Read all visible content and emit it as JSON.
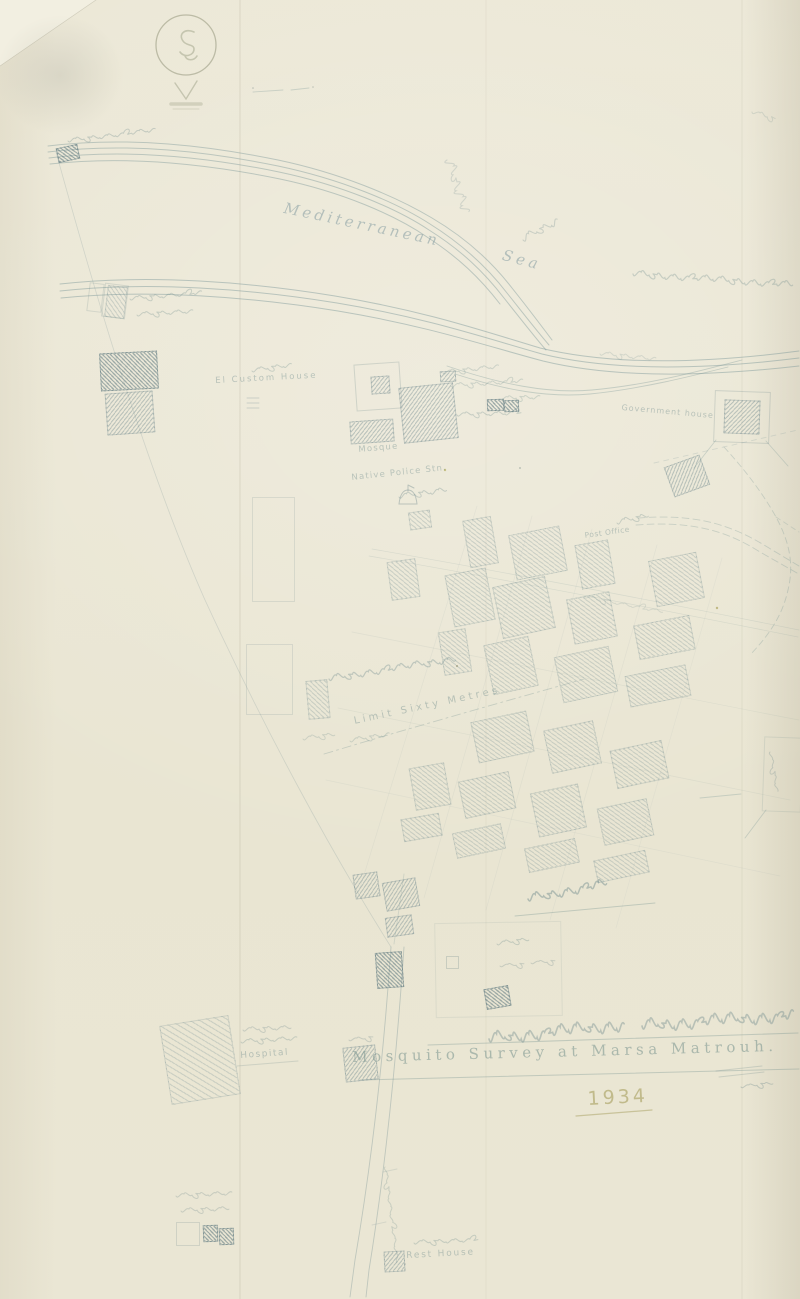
{
  "page": {
    "width": 800,
    "height": 1299,
    "background": "#ebe7d5"
  },
  "colors": {
    "ink": "#7a9496",
    "ink_faint": "#9db0ae",
    "olive": "#a89f60",
    "paper": "#ebe7d5",
    "paper_light": "#f2efe1"
  },
  "map": {
    "labels": [
      {
        "id": "sea-word-1",
        "text": "Mediterranean",
        "x": 286,
        "y": 199,
        "rot": 12,
        "size": 15,
        "ls": 3.5,
        "cls": "lbl-sea"
      },
      {
        "id": "sea-word-2",
        "text": "Sea",
        "x": 505,
        "y": 246,
        "rot": 15,
        "size": 15,
        "ls": 4,
        "cls": "lbl-sea"
      },
      {
        "id": "government-house",
        "text": "Government house",
        "x": 622,
        "y": 403,
        "rot": 5,
        "size": 8,
        "ls": 1,
        "cls": "lbl-small"
      },
      {
        "id": "custom-house",
        "text": "El Custom House",
        "x": 215,
        "y": 376,
        "rot": -3,
        "size": 8.5,
        "ls": 2,
        "cls": "lbl-small"
      },
      {
        "id": "mosque",
        "text": "Mosque",
        "x": 358,
        "y": 445,
        "rot": -5,
        "size": 8.5,
        "ls": 1.2,
        "cls": "lbl-small"
      },
      {
        "id": "native-police-station",
        "text": "Native Police Stn.",
        "x": 351,
        "y": 473,
        "rot": -6,
        "size": 8.5,
        "ls": 1.2,
        "cls": "lbl-small"
      },
      {
        "id": "post-office",
        "text": "Post Office",
        "x": 584,
        "y": 531,
        "rot": -8,
        "size": 7.5,
        "ls": 0.5,
        "cls": "lbl-small"
      },
      {
        "id": "limit-sixty-metres",
        "text": "Limit Sixty Metres",
        "x": 353,
        "y": 716,
        "rot": -12,
        "size": 10,
        "ls": 3.3,
        "cls": "lbl-small"
      },
      {
        "id": "hospital",
        "text": "Hospital",
        "x": 240,
        "y": 1051,
        "rot": -4,
        "size": 9,
        "ls": 1.5,
        "cls": "lbl-small"
      },
      {
        "id": "rest-house",
        "text": "Rest House",
        "x": 406,
        "y": 1251,
        "rot": -3,
        "size": 9,
        "ls": 1.8,
        "cls": "lbl-small"
      },
      {
        "id": "map-title",
        "text": "Mosquito Survey at Marsa Matrouh.",
        "x": 352,
        "y": 1048,
        "rot": -1.5,
        "size": 15,
        "ls": 4.5,
        "cls": "lbl-title"
      },
      {
        "id": "map-year",
        "text": "1934",
        "x": 587,
        "y": 1088,
        "rot": -3,
        "size": 19,
        "ls": 3,
        "cls": "lbl-olive"
      }
    ],
    "blocks": [
      [
        57,
        146,
        20,
        13,
        -12,
        "d"
      ],
      [
        100,
        352,
        56,
        36,
        -3,
        "d"
      ],
      [
        106,
        392,
        46,
        40,
        -4,
        "m"
      ],
      [
        106,
        286,
        18,
        30,
        7,
        "l"
      ],
      [
        440,
        371,
        14,
        9,
        -3,
        "m"
      ],
      [
        487,
        399,
        15,
        10,
        -2,
        "d"
      ],
      [
        504,
        400,
        13,
        10,
        -2,
        "d"
      ],
      [
        401,
        385,
        53,
        54,
        -6,
        "m"
      ],
      [
        350,
        420,
        42,
        21,
        -4,
        "m"
      ],
      [
        371,
        376,
        17,
        16,
        -4,
        "m"
      ],
      [
        724,
        400,
        34,
        32,
        2,
        "m"
      ],
      [
        668,
        460,
        36,
        30,
        -20,
        "m"
      ],
      [
        466,
        518,
        27,
        46,
        -10,
        "l"
      ],
      [
        512,
        530,
        50,
        44,
        -11,
        "l"
      ],
      [
        578,
        542,
        32,
        43,
        -10,
        "l"
      ],
      [
        652,
        556,
        47,
        45,
        -11,
        "l"
      ],
      [
        389,
        560,
        27,
        37,
        -8,
        "l"
      ],
      [
        449,
        571,
        40,
        51,
        -11,
        "l"
      ],
      [
        497,
        581,
        52,
        51,
        -12,
        "l"
      ],
      [
        570,
        595,
        42,
        44,
        -11,
        "l"
      ],
      [
        636,
        620,
        55,
        33,
        -11,
        "l"
      ],
      [
        441,
        630,
        26,
        42,
        -9,
        "l"
      ],
      [
        488,
        640,
        44,
        49,
        -12,
        "l"
      ],
      [
        558,
        651,
        54,
        45,
        -12,
        "l"
      ],
      [
        627,
        670,
        60,
        30,
        -11,
        "l"
      ],
      [
        307,
        680,
        20,
        37,
        -5,
        "l"
      ],
      [
        409,
        511,
        20,
        16,
        -8,
        "l"
      ],
      [
        474,
        716,
        55,
        40,
        -12,
        "l"
      ],
      [
        547,
        725,
        49,
        42,
        -12,
        "l"
      ],
      [
        613,
        745,
        51,
        37,
        -12,
        "l"
      ],
      [
        412,
        765,
        34,
        41,
        -10,
        "l"
      ],
      [
        461,
        776,
        50,
        36,
        -12,
        "l"
      ],
      [
        534,
        788,
        47,
        43,
        -12,
        "l"
      ],
      [
        600,
        803,
        49,
        36,
        -12,
        "l"
      ],
      [
        402,
        816,
        37,
        21,
        -10,
        "l"
      ],
      [
        454,
        828,
        48,
        24,
        -12,
        "l"
      ],
      [
        526,
        843,
        50,
        23,
        -12,
        "l"
      ],
      [
        595,
        855,
        51,
        21,
        -12,
        "l"
      ],
      [
        354,
        873,
        23,
        23,
        -8,
        "m"
      ],
      [
        384,
        880,
        32,
        27,
        -10,
        "m"
      ],
      [
        386,
        916,
        25,
        18,
        -8,
        "m"
      ],
      [
        376,
        952,
        25,
        34,
        -4,
        "d"
      ],
      [
        485,
        987,
        23,
        19,
        -10,
        "d"
      ],
      [
        344,
        1046,
        31,
        33,
        -6,
        "m"
      ],
      [
        165,
        1020,
        68,
        78,
        -9,
        "h"
      ],
      [
        203,
        1225,
        13,
        15,
        -2,
        "d"
      ],
      [
        219,
        1228,
        13,
        15,
        -2,
        "d"
      ],
      [
        384,
        1251,
        19,
        19,
        -3,
        "m"
      ]
    ],
    "outlines": [
      [
        355,
        363,
        44,
        45,
        -4,
        0.45
      ],
      [
        714,
        391,
        54,
        50,
        2,
        0.45
      ],
      [
        252,
        497,
        41,
        103,
        0,
        0.32
      ],
      [
        246,
        644,
        45,
        69,
        0,
        0.32
      ],
      [
        435,
        922,
        125,
        93,
        -1,
        0.22
      ],
      [
        446,
        956,
        11,
        11,
        0,
        0.5
      ],
      [
        88,
        283,
        13,
        27,
        7,
        0.38
      ],
      [
        103,
        284,
        22,
        32,
        7,
        0.38
      ],
      [
        763,
        737,
        37,
        73,
        2,
        0.3
      ],
      [
        176,
        1222,
        22,
        22,
        0,
        0.4
      ]
    ],
    "arabic_scribbles_note": "illegible handwritten Arabic annotations",
    "arabic_scribbles": [
      [
        68,
        141,
        85,
        4,
        -7,
        0.32,
        1
      ],
      [
        523,
        240,
        42,
        7,
        -30,
        0.28,
        1.1
      ],
      [
        447,
        160,
        58,
        10,
        68,
        0.22,
        1.1
      ],
      [
        633,
        274,
        160,
        6,
        4,
        0.3,
        1.2
      ],
      [
        130,
        299,
        68,
        4,
        -5,
        0.3,
        1
      ],
      [
        137,
        315,
        58,
        4,
        -4,
        0.3,
        1
      ],
      [
        252,
        371,
        36,
        4,
        -9,
        0.3,
        1
      ],
      [
        443,
        373,
        58,
        4,
        -7,
        0.26,
        1
      ],
      [
        451,
        386,
        72,
        4,
        -4,
        0.26,
        1
      ],
      [
        500,
        399,
        42,
        4,
        -3,
        0.26,
        1
      ],
      [
        457,
        415,
        66,
        4,
        -2,
        0.3,
        1
      ],
      [
        600,
        354,
        52,
        4,
        5,
        0.2,
        1
      ],
      [
        399,
        497,
        44,
        5,
        -9,
        0.32,
        1
      ],
      [
        617,
        523,
        30,
        5,
        -14,
        0.3,
        1
      ],
      [
        329,
        679,
        126,
        6,
        -9,
        0.35,
        1.2
      ],
      [
        303,
        739,
        30,
        4,
        -8,
        0.24,
        1
      ],
      [
        350,
        741,
        40,
        4,
        -10,
        0.26,
        1
      ],
      [
        528,
        899,
        80,
        8,
        -11,
        0.45,
        1.5
      ],
      [
        497,
        944,
        34,
        4,
        -8,
        0.3,
        1
      ],
      [
        500,
        966,
        26,
        3,
        -3,
        0.28,
        1
      ],
      [
        531,
        963,
        26,
        3,
        -3,
        0.28,
        1
      ],
      [
        489,
        1039,
        138,
        11,
        -6,
        0.4,
        1.6
      ],
      [
        642,
        1026,
        148,
        11,
        -4,
        0.4,
        1.6
      ],
      [
        741,
        1087,
        30,
        3,
        -6,
        0.33,
        1
      ],
      [
        241,
        1042,
        52,
        4,
        -4,
        0.3,
        1
      ],
      [
        243,
        1030,
        46,
        4,
        -3,
        0.28,
        1
      ],
      [
        414,
        1243,
        60,
        4,
        -3,
        0.3,
        1
      ],
      [
        176,
        1196,
        52,
        4,
        -3,
        0.28,
        1
      ],
      [
        181,
        1211,
        46,
        4,
        -3,
        0.28,
        1
      ],
      [
        385,
        1167,
        95,
        3,
        83,
        0.26,
        1
      ],
      [
        770,
        752,
        40,
        3,
        80,
        0.28,
        1
      ],
      [
        752,
        112,
        26,
        4,
        18,
        0.2,
        1
      ],
      [
        584,
        597,
        78,
        3,
        11,
        0.18,
        1
      ],
      [
        349,
        1040,
        26,
        3,
        -5,
        0.28,
        1
      ]
    ]
  }
}
